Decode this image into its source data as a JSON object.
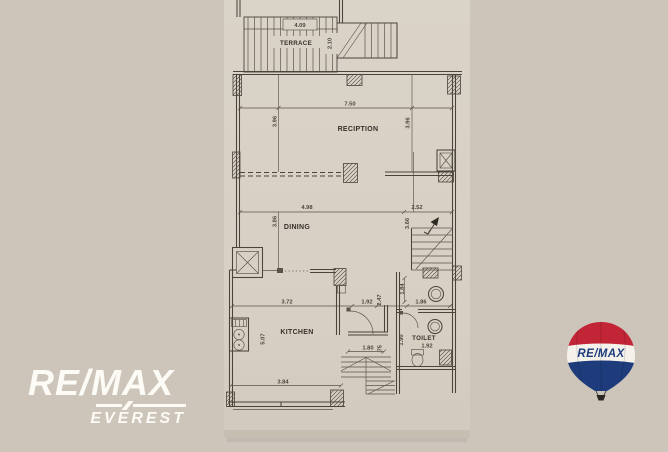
{
  "colors": {
    "background": "#cdc5ba",
    "paper": "#d9d2c6",
    "ink": "#4a443b",
    "balloon_red": "#c22535",
    "balloon_blue": "#1e3c7c",
    "balloon_white": "#f5f2ec"
  },
  "plan": {
    "terrace": {
      "label": "TERRACE",
      "dim_width": "4.09",
      "dim_depth": "2.10"
    },
    "reception": {
      "label": "RECIPTION",
      "dim_width": "7.50",
      "dim_left": "3.96",
      "dim_right": "3.96"
    },
    "dining": {
      "label": "DINING",
      "dim_width": "4.98",
      "dim_stair_width": "2.52",
      "dim_left": "3.86",
      "dim_right": "3.66"
    },
    "kitchen": {
      "label": "KITCHEN",
      "dim_width": "3.72",
      "dim_depth": "5.07",
      "dim_bottom": "3.84"
    },
    "hall": {
      "dim_door": "1.92",
      "dim_depth": "2.47",
      "dim_stair": "1.80",
      "dim_stair_side": ".75"
    },
    "lobby": {
      "dim_depth": "1.84",
      "dim_width": "1.86"
    },
    "toilet": {
      "label": "TOILET",
      "dim_width": "1.92",
      "dim_depth": "1.90"
    }
  },
  "branding": {
    "wordmark_line1": "RE/MAX",
    "wordmark_line2": "EVEREST",
    "balloon_label": "RE/MAX"
  }
}
